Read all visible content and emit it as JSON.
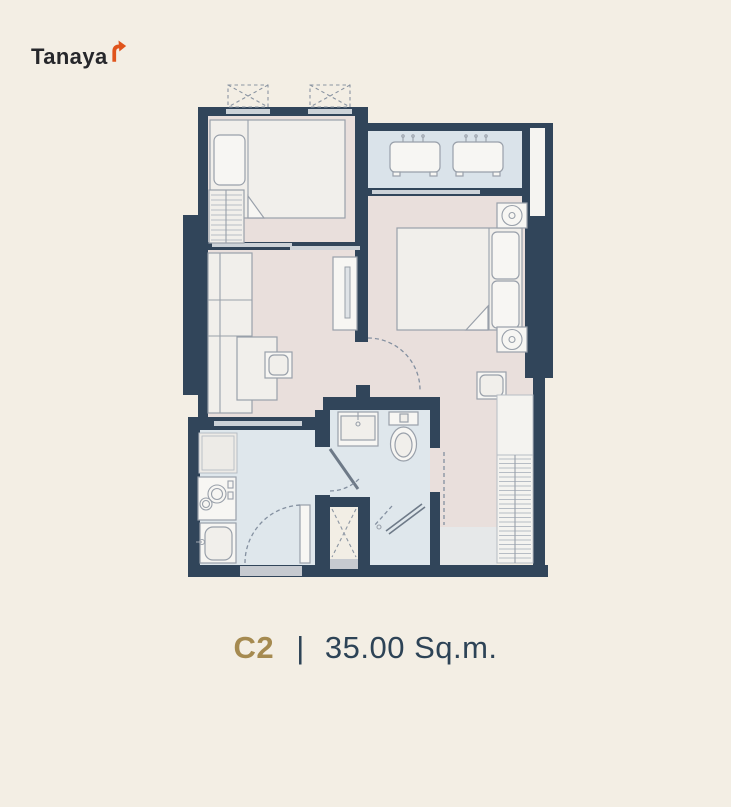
{
  "brand": {
    "name": "Tanaya",
    "logo_mark": "arrow-up-right-icon"
  },
  "caption": {
    "unit_code": "C2",
    "separator": "|",
    "area": "35.00 Sq.m."
  },
  "palette": {
    "background": "#f3eee4",
    "walls": "#31455a",
    "floor_warm": "#e9dfdc",
    "floor_cool": "#dfe7ec",
    "balcony_floor": "#dae3ea",
    "furniture_fill": "#f1efeb",
    "furniture_outline": "#99a0aa",
    "caption_navy": "#2d4356",
    "caption_gold": "#a58a50",
    "logo_orange": "#e0541c",
    "logo_black": "#26272b"
  },
  "floorplan": {
    "type": "condo-unit-floor-plan",
    "rooms": [
      "bedroom",
      "living-area",
      "master-bedroom",
      "balcony",
      "kitchen",
      "bathroom",
      "shower",
      "shaft"
    ],
    "symbols": [
      "single-bed",
      "double-bed",
      "pillows",
      "wardrobe-hanging-rail",
      "sofa",
      "coffee-table",
      "tv-console",
      "ac-condenser-unit",
      "ac-ledge-dashed-box",
      "washing-machine",
      "two-burner-stove",
      "kitchen-sink",
      "wash-basin",
      "toilet",
      "shower-door",
      "door-swing-arc",
      "sliding-door",
      "bedside-table",
      "stool"
    ]
  }
}
